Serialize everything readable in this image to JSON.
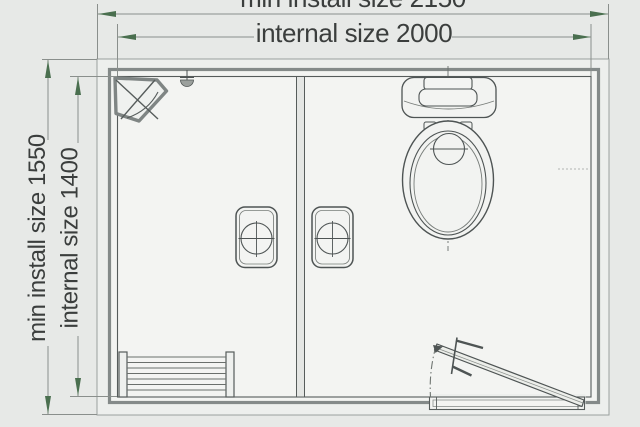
{
  "dimension_labels": {
    "top_outer": "min install size 2150",
    "top_inner": "internal size 2000",
    "left_outer": "min install size 1550",
    "left_inner": "internal size 1400"
  },
  "dimension_values": {
    "min_install_width": 2150,
    "internal_width": 2000,
    "min_install_height": 1550,
    "internal_height": 1400
  },
  "fixtures": [
    "corner-shower",
    "shower-head",
    "radiator",
    "washbasin-left",
    "washbasin-right",
    "toilet",
    "door-leaf",
    "door-threshold",
    "door-swing-arc",
    "partition-wall"
  ],
  "colors": {
    "background": "#e7e9e7",
    "paper_inner": "#f3f4f2",
    "drawing_line": "#4e5454",
    "wall_line": "#848a89",
    "dimension_line": "#8a8f8c",
    "arrow_green": "#4a6f4f",
    "text": "#3b3e3d"
  }
}
